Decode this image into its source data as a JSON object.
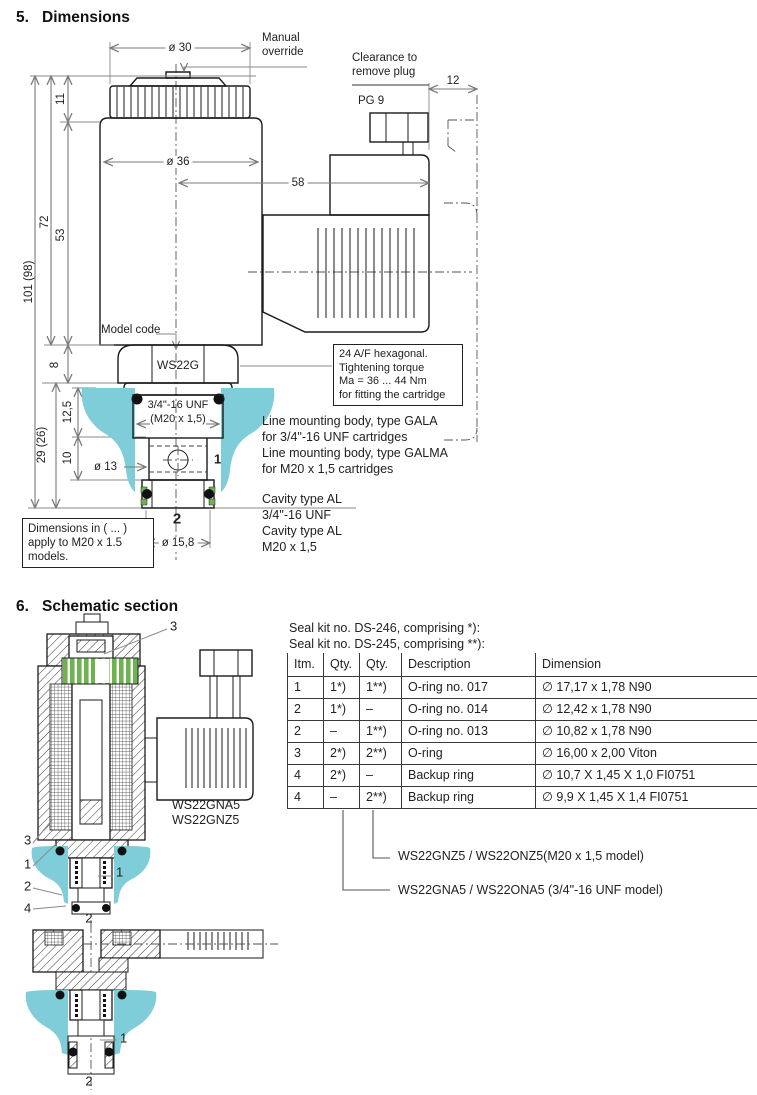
{
  "colors": {
    "cyan": "#7ecdd9",
    "green": "#6db450",
    "line": "#1b1b1b",
    "dim_line": "#7a7a7a"
  },
  "s5": {
    "num": "5.",
    "title": "Dimensions",
    "dims": {
      "dia30": "ø 30",
      "d11": "11",
      "d72": "72",
      "d53": "53",
      "d101": "101  (98)",
      "d8": "8",
      "d125": "12,5",
      "d29": "29  (26)",
      "d10": "10",
      "dia36": "ø 36",
      "d58": "58",
      "d12": "12",
      "dia13": "ø 13",
      "dia158": "ø 15,8",
      "port1": "1",
      "port2": "2"
    },
    "labels": {
      "manual": [
        "Manual",
        "override"
      ],
      "clearance": [
        "Clearance to",
        "remove plug"
      ],
      "pg9": "PG 9",
      "model_code": "Model code",
      "ws22g": "WS22G",
      "thread": [
        "3/4\"-16 UNF",
        "(M20 x 1,5)"
      ]
    },
    "hex_note": [
      "24 A/F hexagonal.",
      "Tightening torque",
      "Ma = 36 ... 44 Nm",
      "for fitting the cartridge"
    ],
    "mount_note": [
      "Line mounting body, type GALA",
      "for 3/4\"-16 UNF cartridges",
      "Line mounting body, type GALMA",
      "for M20 x 1,5 cartridges"
    ],
    "cavity_note": [
      "Cavity type AL",
      "3/4\"-16 UNF",
      "Cavity type AL",
      "M20 x 1,5"
    ],
    "dims_note": [
      "Dimensions in ( ... )",
      "apply to M20 x 1.5",
      "models."
    ]
  },
  "s6": {
    "num": "6.",
    "title": "Schematic section",
    "model_label": [
      "WS22GNA5",
      "WS22GNZ5"
    ],
    "callouts": {
      "c1": "1",
      "c2": "2",
      "c3": "3",
      "c4": "4"
    },
    "seal_kits": [
      "Seal kit no. DS-246, comprising *):",
      "Seal kit no. DS-245, comprising **):"
    ],
    "table": {
      "headers": [
        "Itm.",
        "Qty.",
        "Qty.",
        "Description",
        "Dimension"
      ],
      "rows": [
        [
          "1",
          "1*)",
          "1**)",
          "O-ring no. 017",
          "∅ 17,17 x 1,78 N90"
        ],
        [
          "2",
          "1*)",
          "–",
          "O-ring no. 014",
          "∅ 12,42 x 1,78 N90"
        ],
        [
          "2",
          "–",
          "1**)",
          "O-ring no. 013",
          "∅ 10,82 x 1,78 N90"
        ],
        [
          "3",
          "2*)",
          "2**)",
          "O-ring",
          "∅ 16,00 x 2,00 Viton"
        ],
        [
          "4",
          "2*)",
          "–",
          "Backup ring",
          "∅ 10,7 X 1,45 X 1,0 FI0751"
        ],
        [
          "4",
          "–",
          "2**)",
          "Backup ring",
          "∅ 9,9 X 1,45 X 1,4 FI0751"
        ]
      ]
    },
    "model_lines": [
      "WS22GNZ5 / WS22ONZ5(M20 x 1,5 model)",
      "WS22GNA5 / WS22ONA5 (3/4\"-16 UNF model)"
    ]
  }
}
